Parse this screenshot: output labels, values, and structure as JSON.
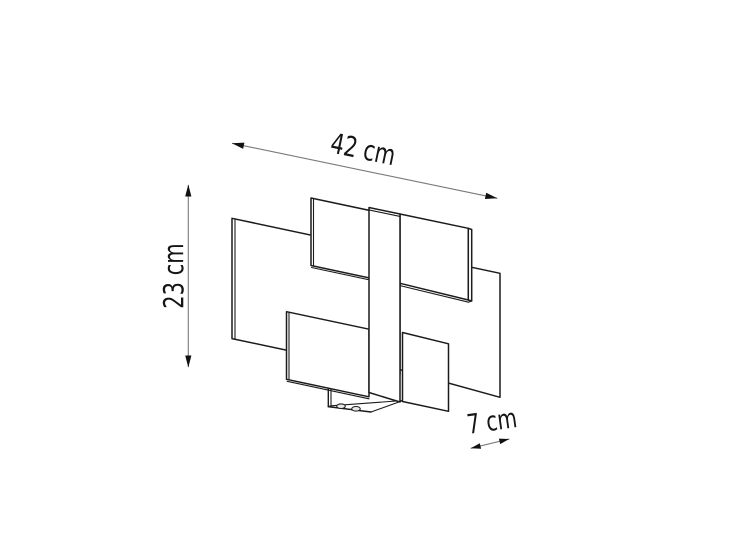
{
  "page": {
    "background_color": "#ffffff"
  },
  "diagram": {
    "kind": "product-dimension-line-drawing",
    "subject": "wall-lamp-with-staggered-rectangular-plates",
    "dimensions": {
      "width": {
        "label": "42 cm",
        "value": 42,
        "unit": "cm"
      },
      "height": {
        "label": "23 cm",
        "value": 23,
        "unit": "cm"
      },
      "depth": {
        "label": "7 cm",
        "value": 7,
        "unit": "cm"
      }
    },
    "colors": {
      "outline": "#1c1c1c",
      "dimension_line": "#7a7a7a",
      "arrowhead": "#111111",
      "label_text": "#151515",
      "surface_fill": "#ffffff",
      "screw_fill": "#e8e8e8"
    }
  }
}
